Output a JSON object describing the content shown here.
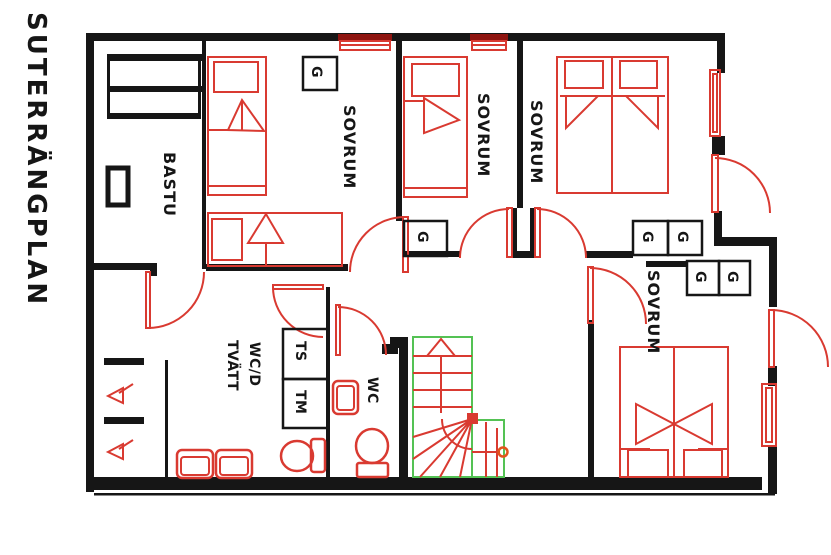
{
  "title": "SUTERRÄNGPLAN",
  "plan": {
    "rooms": {
      "bastu": {
        "label": "BASTU"
      },
      "sovrum_1": {
        "label": "SOVRUM"
      },
      "sovrum_2": {
        "label": "SOVRUM"
      },
      "sovrum_3": {
        "label": "SOVRUM"
      },
      "sovrum_4": {
        "label": "SOVRUM"
      },
      "laundry": {
        "label_line1": "WC/D",
        "label_line2": "TVÄTT"
      },
      "wc": {
        "label": "WC"
      }
    },
    "fixtures": {
      "wardrobe_label": "G",
      "wardrobe_count": 6,
      "drying_cabinet_label": "TS",
      "washing_machine_label": "TM"
    },
    "colors": {
      "walls": "#161616",
      "fixtures_red": "#d93a31",
      "stairs_green": "#54c254",
      "window_dark_red": "#8e1410"
    }
  }
}
